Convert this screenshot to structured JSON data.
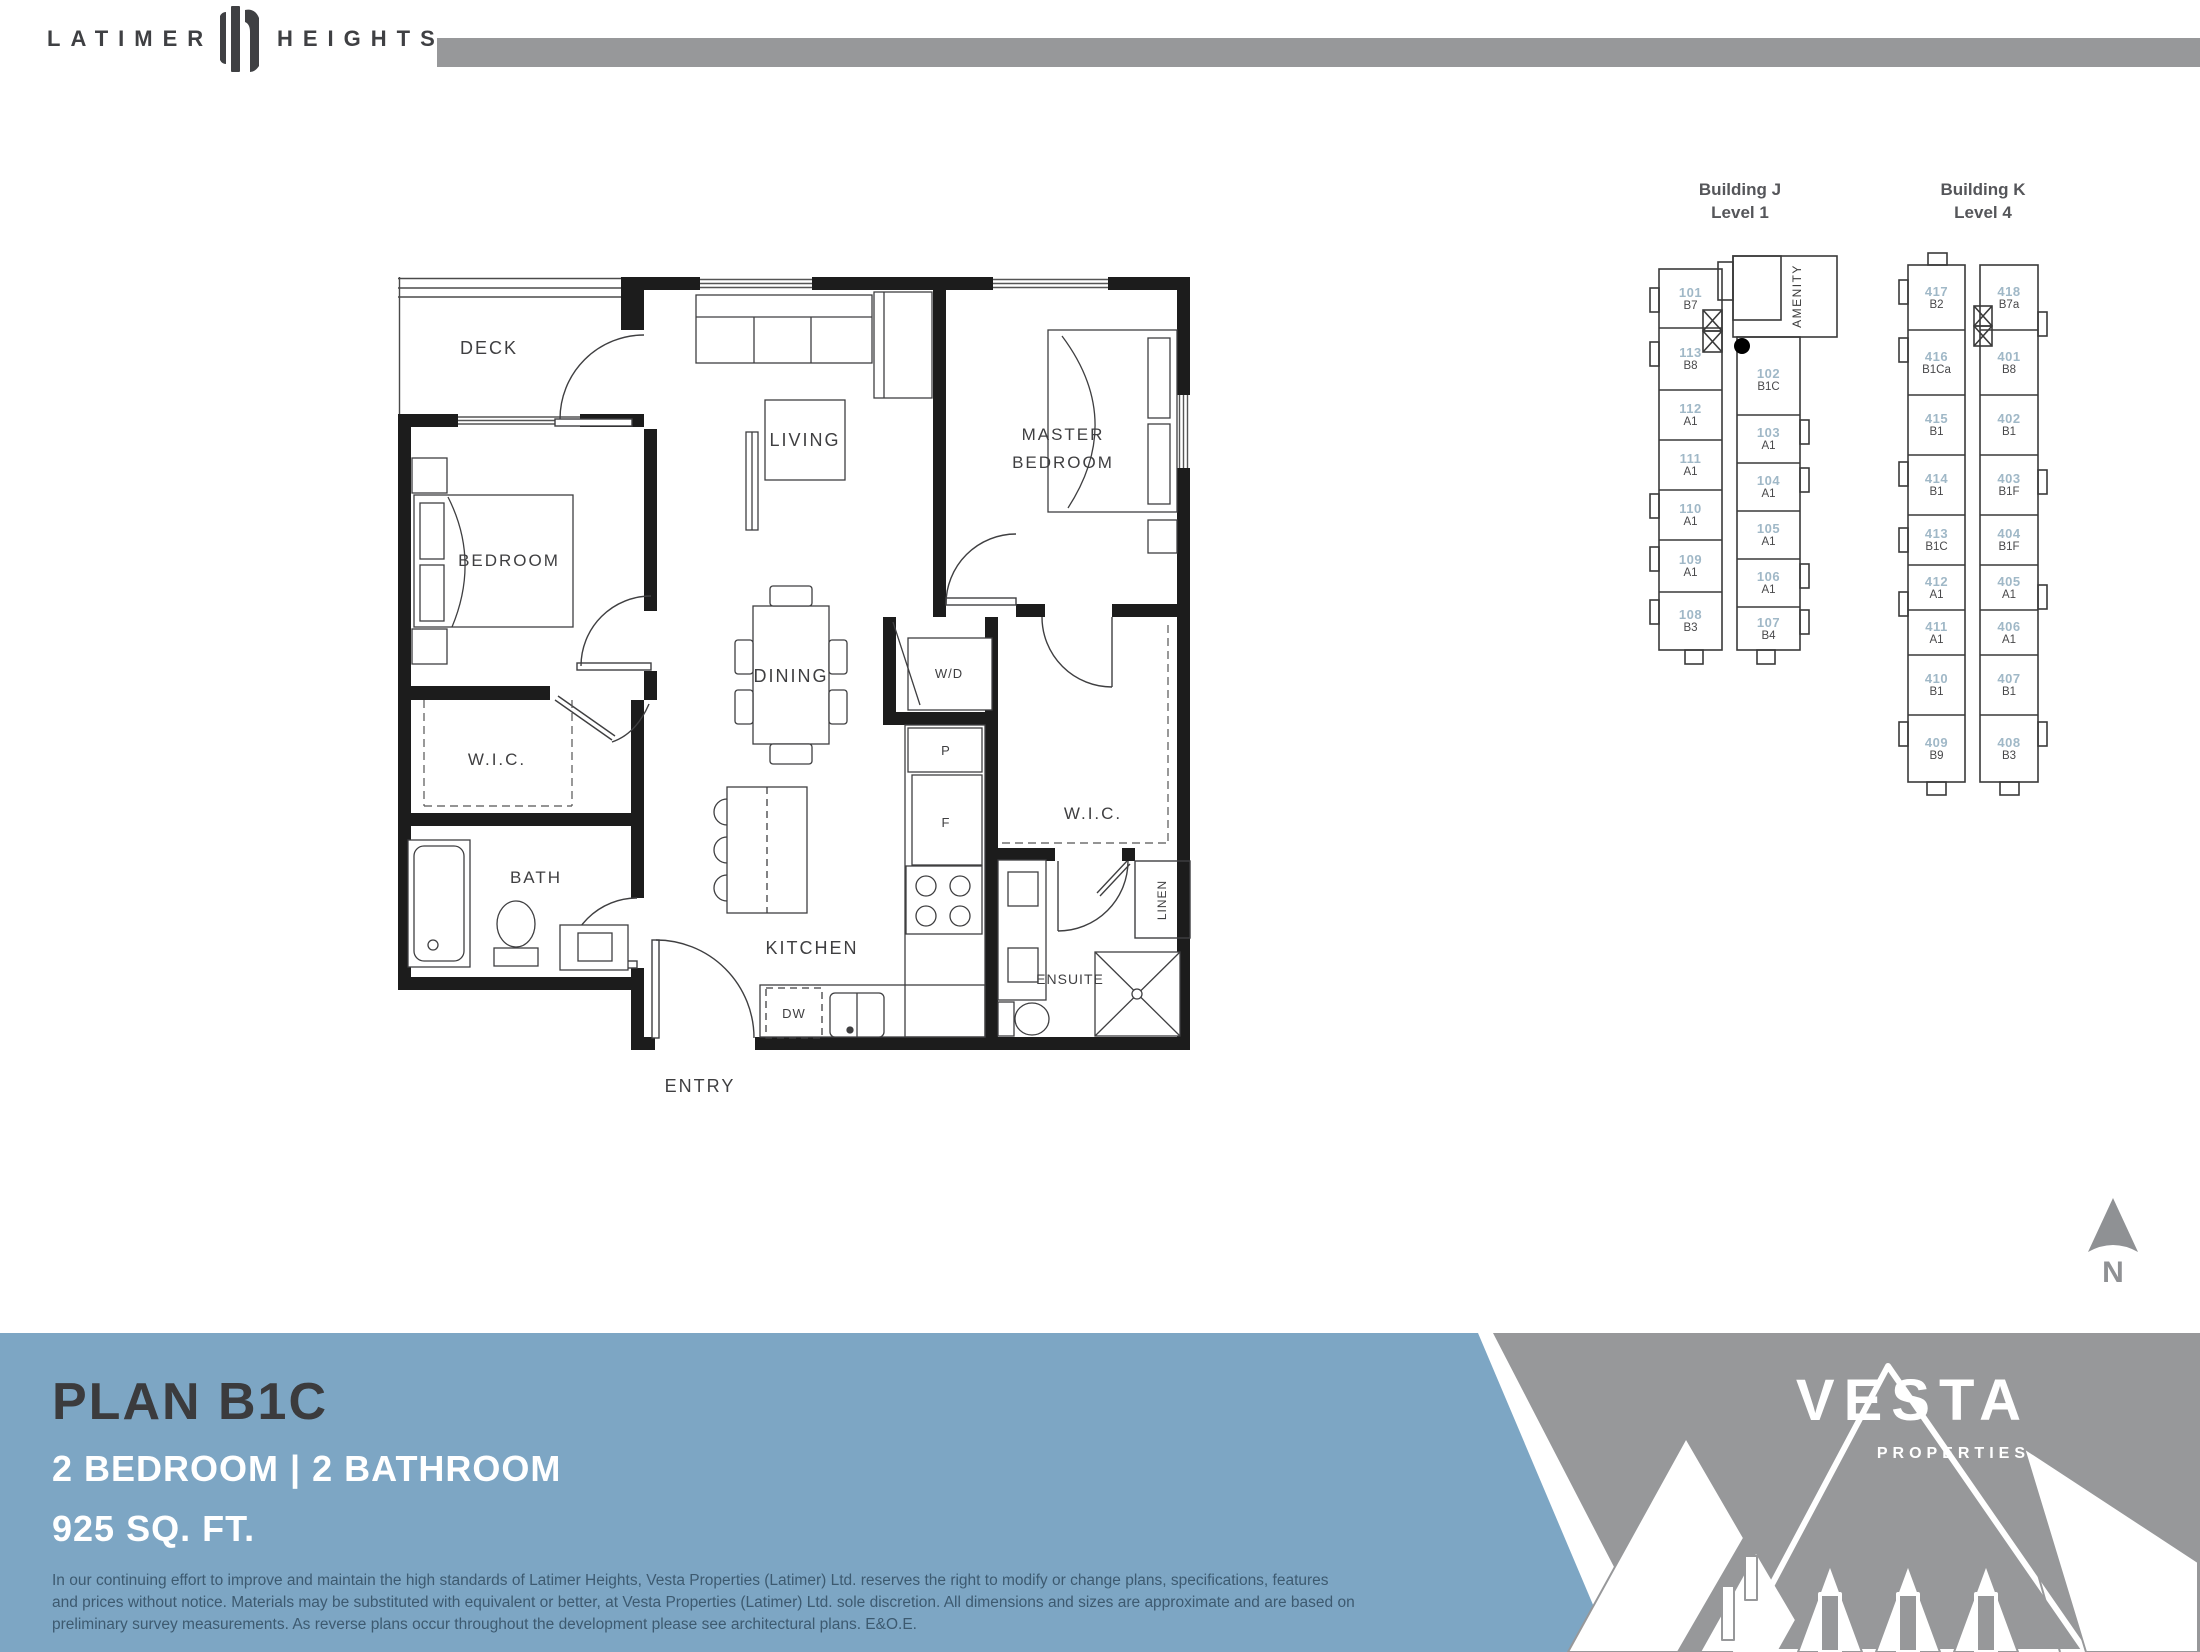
{
  "header": {
    "latimer": "LATIMER",
    "heights": "HEIGHTS"
  },
  "floorplan": {
    "labels": {
      "deck": "DECK",
      "living": "LIVING",
      "master1": "MASTER",
      "master2": "BEDROOM",
      "bedroom": "BEDROOM",
      "dining": "DINING",
      "wd": "W/D",
      "wic_left": "W.I.C.",
      "wic_right": "W.I.C.",
      "bath": "BATH",
      "pantry": "P",
      "fridge": "F",
      "kitchen": "KITCHEN",
      "dw": "DW",
      "ensuite": "ENSUITE",
      "linen": "LINEN",
      "entry": "ENTRY"
    }
  },
  "keyplans": [
    {
      "title1": "Building J",
      "title2": "Level 1",
      "amenity": "AMENITY",
      "left": [
        {
          "number": "101",
          "code": "B7"
        },
        {
          "number": "113",
          "code": "B8"
        },
        {
          "number": "112",
          "code": "A1"
        },
        {
          "number": "111",
          "code": "A1"
        },
        {
          "number": "110",
          "code": "A1"
        },
        {
          "number": "109",
          "code": "A1"
        },
        {
          "number": "108",
          "code": "B3"
        }
      ],
      "right": [
        {
          "number": "102",
          "code": "B1C"
        },
        {
          "number": "103",
          "code": "A1"
        },
        {
          "number": "104",
          "code": "A1"
        },
        {
          "number": "105",
          "code": "A1"
        },
        {
          "number": "106",
          "code": "A1"
        },
        {
          "number": "107",
          "code": "B4"
        }
      ]
    },
    {
      "title1": "Building K",
      "title2": "Level 4",
      "left": [
        {
          "number": "417",
          "code": "B2"
        },
        {
          "number": "416",
          "code": "B1Ca"
        },
        {
          "number": "415",
          "code": "B1"
        },
        {
          "number": "414",
          "code": "B1"
        },
        {
          "number": "413",
          "code": "B1C"
        },
        {
          "number": "412",
          "code": "A1"
        },
        {
          "number": "411",
          "code": "A1"
        },
        {
          "number": "410",
          "code": "B1"
        },
        {
          "number": "409",
          "code": "B9"
        }
      ],
      "right": [
        {
          "number": "418",
          "code": "B7a"
        },
        {
          "number": "401",
          "code": "B8"
        },
        {
          "number": "402",
          "code": "B1"
        },
        {
          "number": "403",
          "code": "B1F"
        },
        {
          "number": "404",
          "code": "B1F"
        },
        {
          "number": "405",
          "code": "A1"
        },
        {
          "number": "406",
          "code": "A1"
        },
        {
          "number": "407",
          "code": "B1"
        },
        {
          "number": "408",
          "code": "B3"
        }
      ]
    }
  ],
  "banner": {
    "plan_title": "PLAN B1C",
    "spec": "2 BEDROOM | 2 BATHROOM",
    "area": "925 SQ. FT.",
    "disclaimer": [
      "In our continuing effort to improve and maintain the high standards of Latimer Heights, Vesta Properties (Latimer) Ltd. reserves the right to modify or change plans, specifications, features",
      "and prices without notice. Materials may be substituted with equivalent or better, at Vesta Properties (Latimer) Ltd. sole discretion. All dimensions and sizes are approximate and are based on",
      "preliminary survey measurements. As reverse plans occur throughout the development please see architectural plans. E&O.E."
    ]
  },
  "vesta": {
    "name": "VESTA",
    "sub": "PROPERTIES"
  },
  "compass": {
    "n": "N"
  },
  "colors": {
    "banner_blue": "#7da6c4",
    "banner_gray": "#97989a",
    "unit_number_blue": "#a0b8c7",
    "code_gray": "#48484a",
    "title_charcoal": "#3b3b3d",
    "wall_black": "#1c1c1c"
  }
}
